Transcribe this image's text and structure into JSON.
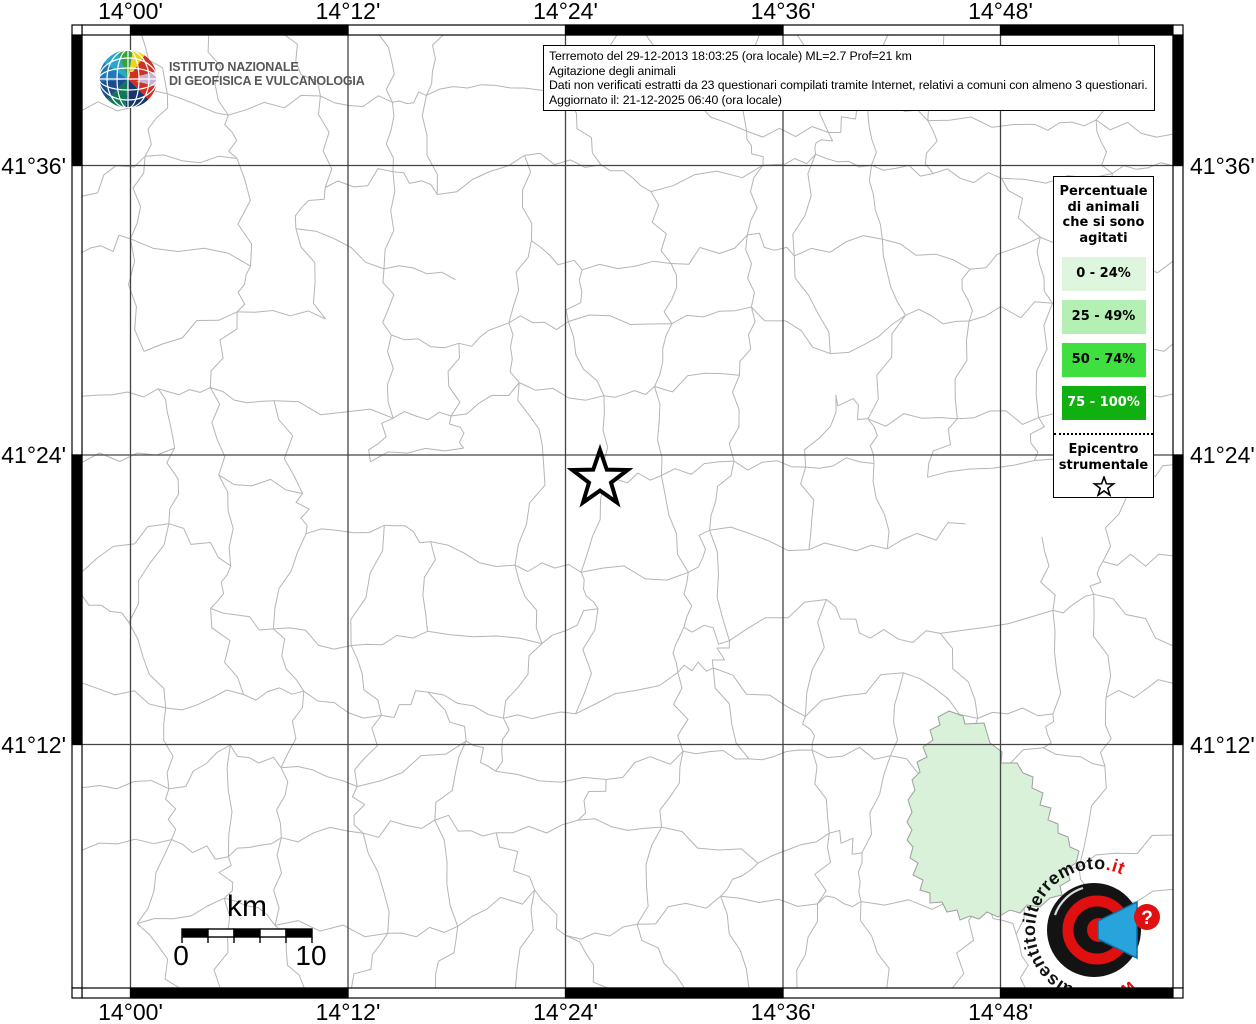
{
  "info_box": {
    "lines": [
      "Terremoto del 29-12-2013 18:03:25 (ora locale) ML=2.7 Prof=21 km",
      "Agitazione degli animali",
      "Dati non verificati estratti da 23 questionari compilati tramite Internet, relativi a comuni con almeno 3 questionari.",
      "Aggiornato il: 21-12-2025 06:40 (ora locale)"
    ]
  },
  "ingv_logo": {
    "line1": "ISTITUTO NAZIONALE",
    "line2": "DI GEOFISICA E VULCANOLOGIA"
  },
  "axis_labels": {
    "top": [
      "14°00'",
      "14°12'",
      "14°24'",
      "14°36'",
      "14°48'"
    ],
    "bottom": [
      "14°00'",
      "14°12'",
      "14°24'",
      "14°36'",
      "14°48'"
    ],
    "left": [
      "41°36'",
      "41°24'",
      "41°12'"
    ],
    "right": [
      "41°36'",
      "41°24'",
      "41°12'"
    ]
  },
  "legend": {
    "title_lines": [
      "Percentuale",
      "di animali",
      "che si sono",
      "agitati"
    ],
    "classes": [
      {
        "label": "0 - 24%",
        "color": "#ddf6dd",
        "text_color": "#000000"
      },
      {
        "label": "25 - 49%",
        "color": "#b4f0b4",
        "text_color": "#000000"
      },
      {
        "label": "50 - 74%",
        "color": "#3fdf3f",
        "text_color": "#000000"
      },
      {
        "label": "75 - 100%",
        "color": "#10b010",
        "text_color": "#ffffff"
      }
    ],
    "epicenter_lines": [
      "Epicentro",
      "strumentale"
    ],
    "epicenter_symbol": "star-outline"
  },
  "scalebar": {
    "unit": "km",
    "start_label": "0",
    "end_label": "10"
  },
  "watermark": {
    "prefix_red": "www.",
    "text_black": "haisentitoilterremoto",
    "suffix_red": ".it",
    "question_mark": "?"
  },
  "map": {
    "grid_x_px": [
      130.5,
      348,
      565.5,
      783,
      1000.5
    ],
    "grid_y_px": [
      165.5,
      455,
      744.5
    ],
    "epicenter_px": {
      "x": 600,
      "y": 479
    },
    "highlighted_municipality": {
      "class_label": "0 - 24%",
      "fill": "#d8f1d8",
      "points": [
        [
          949,
          711
        ],
        [
          963,
          716
        ],
        [
          965,
          724
        ],
        [
          984,
          723
        ],
        [
          990,
          743
        ],
        [
          1002,
          752
        ],
        [
          1001,
          763
        ],
        [
          1017,
          763
        ],
        [
          1023,
          773
        ],
        [
          1033,
          777
        ],
        [
          1032,
          788
        ],
        [
          1043,
          793
        ],
        [
          1040,
          805
        ],
        [
          1051,
          808
        ],
        [
          1048,
          820
        ],
        [
          1058,
          824
        ],
        [
          1058,
          833
        ],
        [
          1068,
          837
        ],
        [
          1070,
          847
        ],
        [
          1079,
          851
        ],
        [
          1076,
          863
        ],
        [
          1067,
          869
        ],
        [
          1070,
          880
        ],
        [
          1060,
          886
        ],
        [
          1062,
          895
        ],
        [
          1050,
          898
        ],
        [
          1040,
          907
        ],
        [
          1027,
          905
        ],
        [
          1020,
          913
        ],
        [
          1010,
          910
        ],
        [
          998,
          917
        ],
        [
          987,
          912
        ],
        [
          979,
          919
        ],
        [
          970,
          916
        ],
        [
          960,
          920
        ],
        [
          957,
          910
        ],
        [
          947,
          912
        ],
        [
          942,
          902
        ],
        [
          930,
          903
        ],
        [
          930,
          893
        ],
        [
          920,
          890
        ],
        [
          923,
          880
        ],
        [
          913,
          875
        ],
        [
          918,
          863
        ],
        [
          910,
          858
        ],
        [
          913,
          847
        ],
        [
          907,
          840
        ],
        [
          912,
          830
        ],
        [
          907,
          822
        ],
        [
          912,
          812
        ],
        [
          908,
          800
        ],
        [
          915,
          790
        ],
        [
          912,
          780
        ],
        [
          920,
          772
        ],
        [
          917,
          762
        ],
        [
          927,
          757
        ],
        [
          923,
          747
        ],
        [
          933,
          740
        ],
        [
          930,
          730
        ],
        [
          940,
          725
        ],
        [
          938,
          717
        ]
      ]
    }
  },
  "colors": {
    "grid": "#444444",
    "boundaries": "#b5b5b5",
    "frame": "#000000",
    "watermark_red": "#e01010",
    "watermark_blue": "#28a3dc"
  }
}
